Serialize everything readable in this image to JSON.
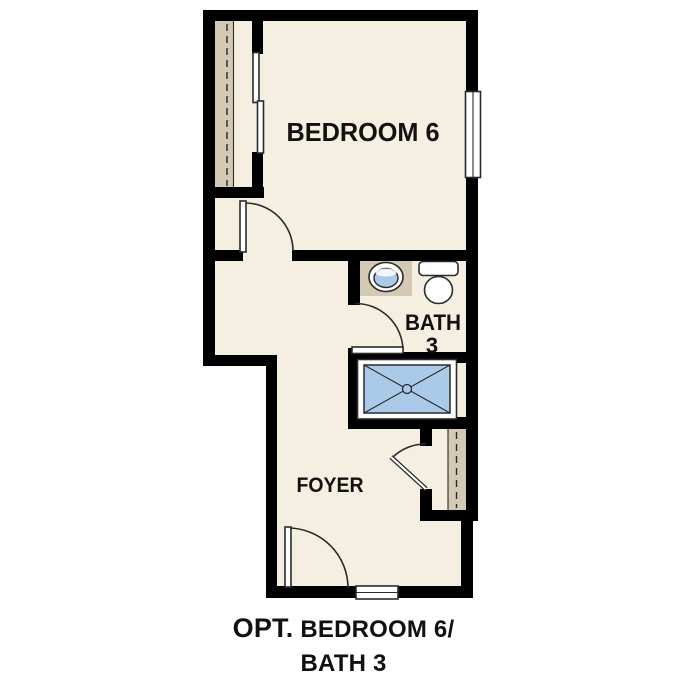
{
  "colors": {
    "wall": "#000000",
    "floor": "#F5EFE2",
    "closet": "#D3C9B5",
    "fixture_blue": "#ABC9E8",
    "line": "#2A2A2A",
    "text": "#111111",
    "background": "#FFFFFF"
  },
  "rooms": {
    "bedroom": {
      "label": "BEDROOM 6"
    },
    "bath": {
      "label": "BATH",
      "number": "3"
    },
    "foyer": {
      "label": "FOYER"
    }
  },
  "caption": {
    "prefix": "OPT.",
    "line1_rest": "BEDROOM 6/",
    "line2": "BATH 3"
  }
}
